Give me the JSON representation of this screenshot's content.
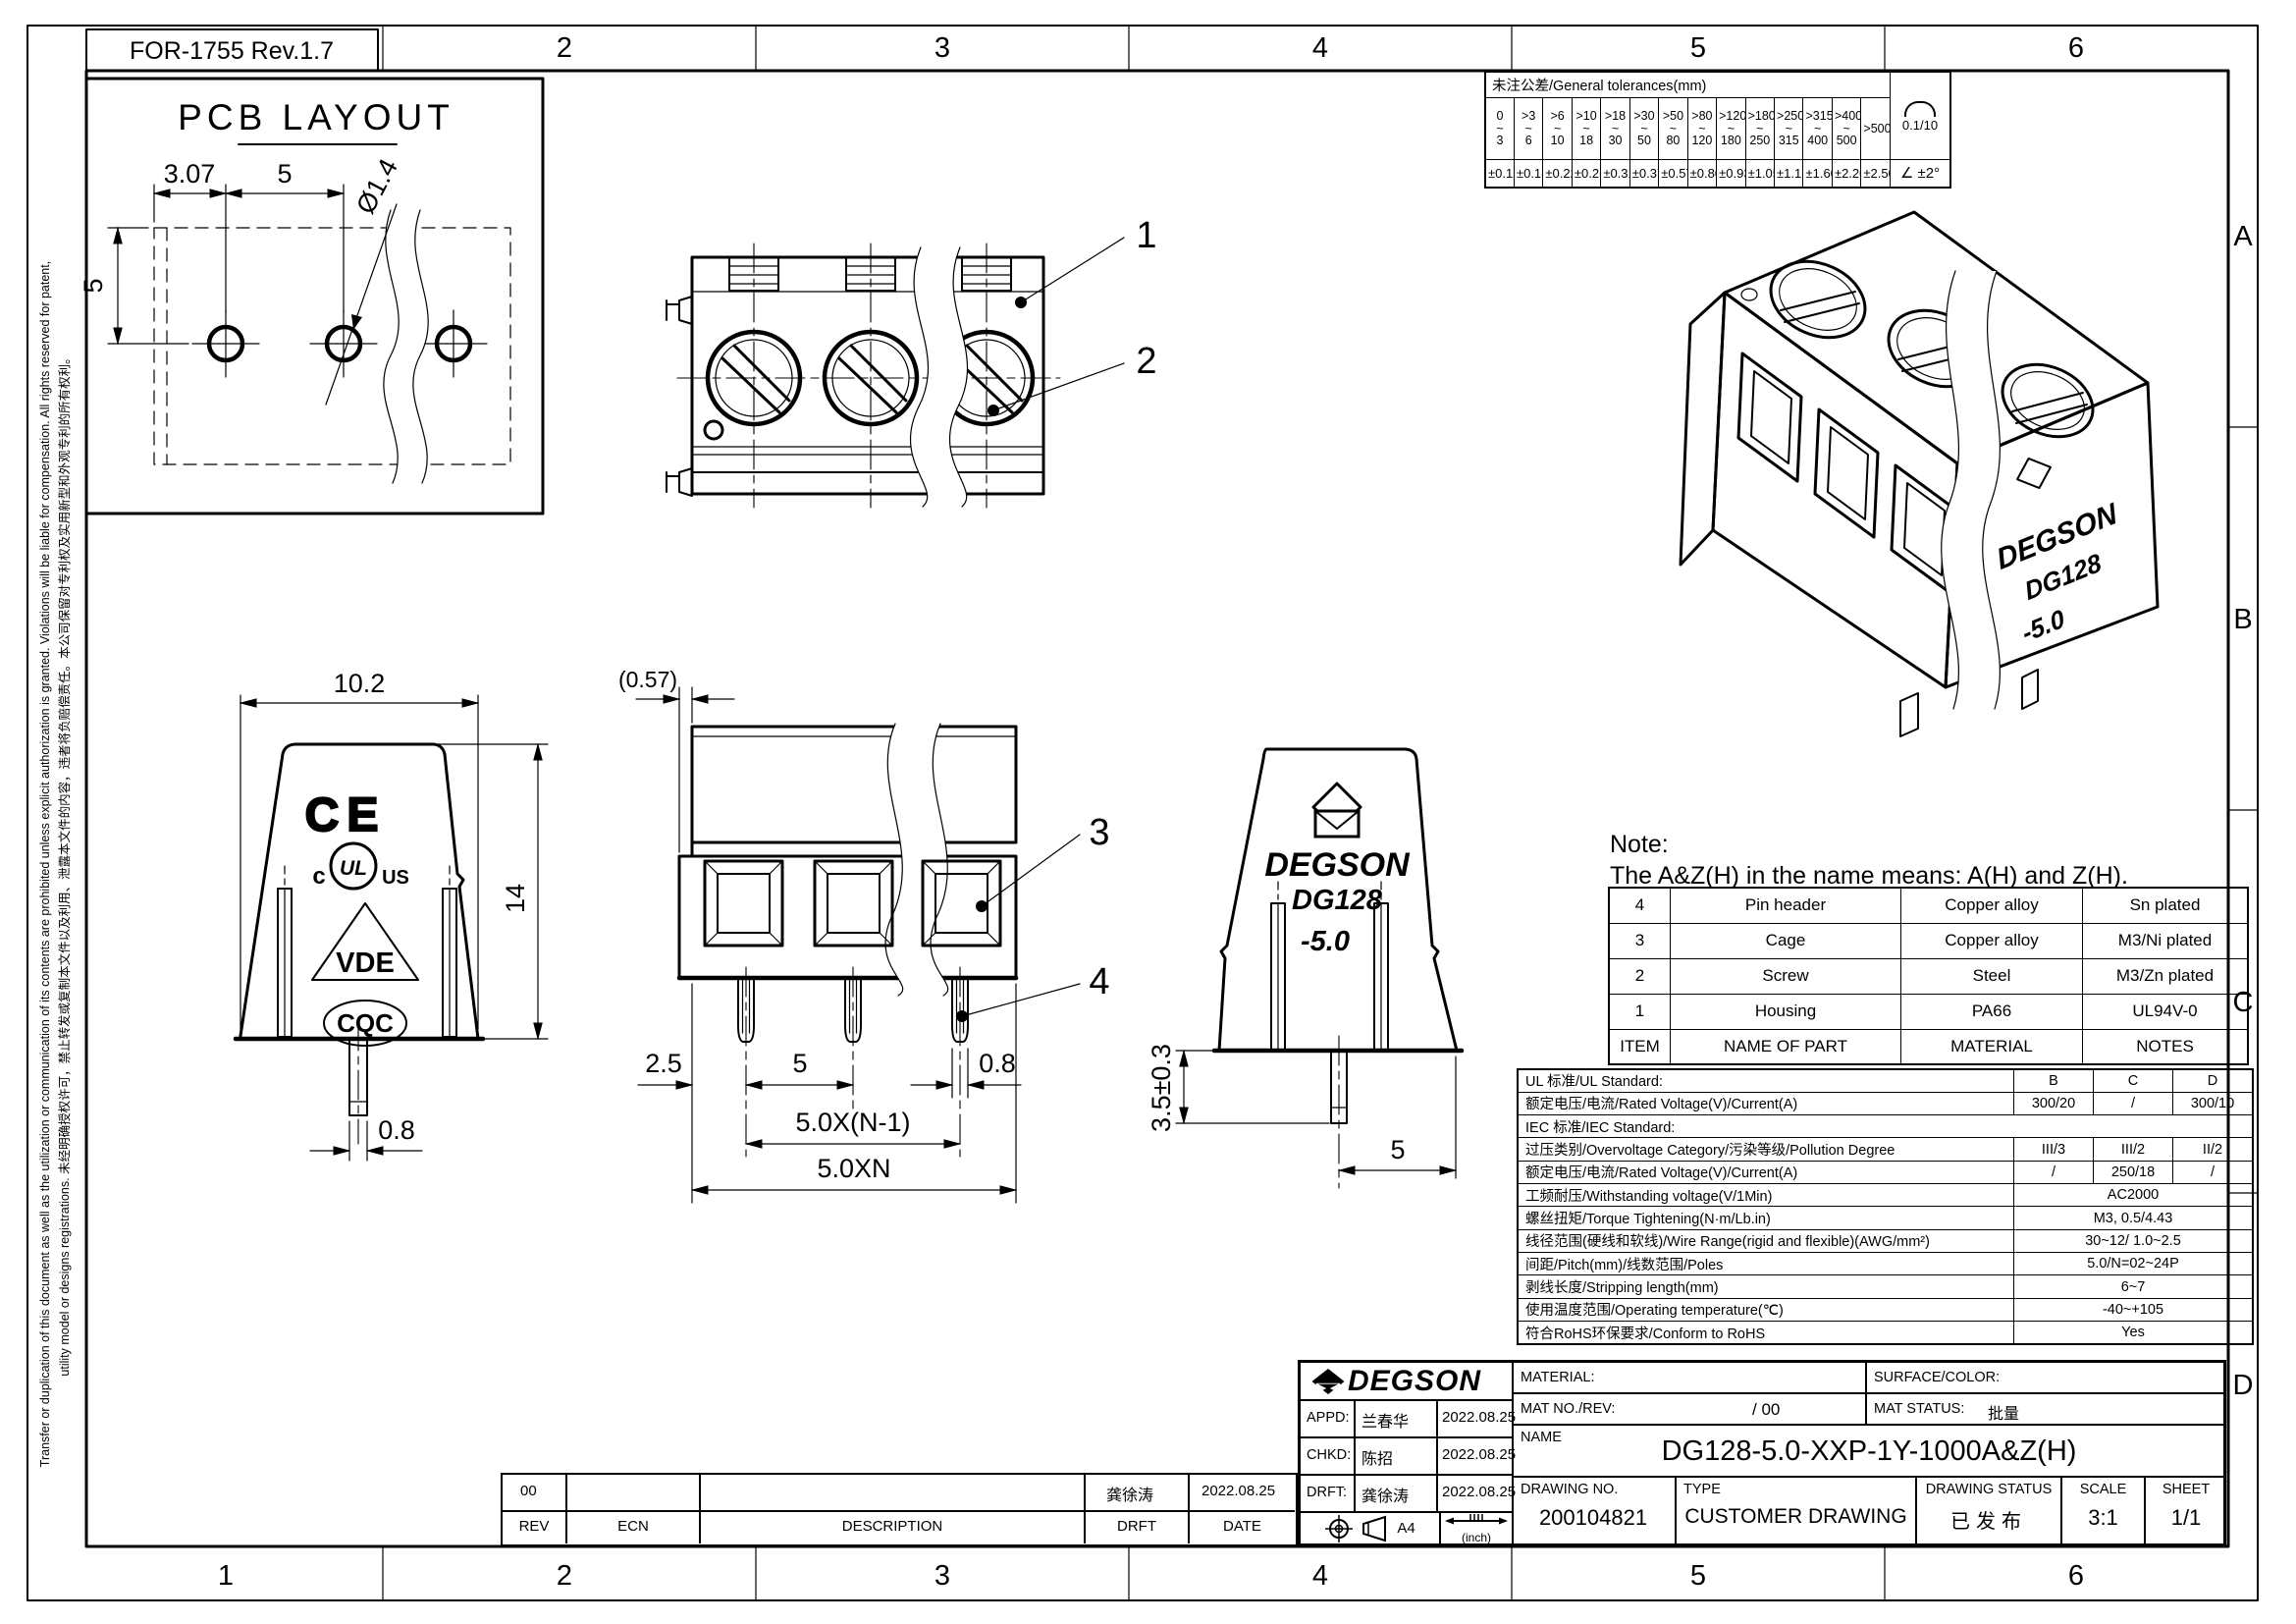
{
  "frame": {
    "form_label": "FOR-1755 Rev.1.7",
    "cols_top": [
      "2",
      "3",
      "4",
      "5",
      "6"
    ],
    "cols_bottom": [
      "1",
      "2",
      "3",
      "4",
      "5",
      "6"
    ],
    "rows_right": [
      "A",
      "B",
      "C",
      "D"
    ],
    "disclaimer_line1": "Transfer or duplication of this document as well as the utilization or communication of its contents are prohibited unless explicit authorization is granted. Violations will be liable for compensation. All rights reserved for patent,",
    "disclaimer_line2": "utility model or designs registrations. 未经明确授权许可，禁止转发或复制本文件以及利用、泄露本文件的内容，违者将负赔偿责任。本公司保留对专利权及实用新型和外观专利的所有权利。"
  },
  "pcb": {
    "title": "PCB LAYOUT"
  },
  "dims": {
    "pcb_307": "3.07",
    "pcb_5h": "5",
    "pcb_5v": "5",
    "pcb_dia": "Ø1.4",
    "end_102": "10.2",
    "end_14": "14",
    "end_08": "0.8",
    "front_057": "(0.57)",
    "front_25": "2.5",
    "front_5": "5",
    "front_08": "0.8",
    "front_pitch": "5.0X(N-1)",
    "front_total": "5.0XN",
    "back_35": "3.5±0.3",
    "back_5": "5"
  },
  "callouts": {
    "c1": "1",
    "c2": "2",
    "c3": "3",
    "c4": "4"
  },
  "marks": {
    "ce": "CE",
    "ul_c": "c",
    "ul": "UL",
    "ul_us": "US",
    "vde": "VDE",
    "cqc": "CQC"
  },
  "branding": {
    "brand": "DEGSON",
    "model": "DG128",
    "pitch": "-5.0"
  },
  "note": {
    "line1": "Note:",
    "line2": "The A&Z(H) in the name means: A(H) and Z(H)."
  },
  "tolerances": {
    "title": "未注公差/General tolerances(mm)",
    "ranges": [
      "0\n~\n3",
      ">3\n~\n6",
      ">6\n~\n10",
      ">10\n~\n18",
      ">18\n~\n30",
      ">30\n~\n50",
      ">50\n~\n80",
      ">80\n~\n120",
      ">120\n~\n180",
      ">180\n~\n250",
      ">250\n~\n315",
      ">315\n~\n400",
      ">400\n~\n500",
      ">500"
    ],
    "values": [
      "±0.12",
      "±0.18",
      "±0.22",
      "±0.26",
      "±0.31",
      "±0.37",
      "±0.57",
      "±0.80",
      "±0.93",
      "±1.05",
      "±1.15",
      "±1.60",
      "±2.20",
      "±2.50"
    ],
    "flatness": "0.1/10",
    "angle_symbol": "∠",
    "angle": "±2°"
  },
  "parts": {
    "headers": [
      "ITEM",
      "NAME OF PART",
      "MATERIAL",
      "NOTES"
    ],
    "rows": [
      [
        "4",
        "Pin header",
        "Copper alloy",
        "Sn plated"
      ],
      [
        "3",
        "Cage",
        "Copper alloy",
        "M3/Ni plated"
      ],
      [
        "2",
        "Screw",
        "Steel",
        "M3/Zn plated"
      ],
      [
        "1",
        "Housing",
        "PA66",
        "UL94V-0"
      ]
    ]
  },
  "specs": {
    "rows": [
      {
        "label": "UL 标准/UL Standard:",
        "b": "B",
        "c": "C",
        "d": "D"
      },
      {
        "label": "额定电压/电流/Rated Voltage(V)/Current(A)",
        "b": "300/20",
        "c": "/",
        "d": "300/10"
      },
      {
        "label": "IEC 标准/IEC Standard:"
      },
      {
        "label": "过压类别/Overvoltage Category/污染等级/Pollution Degree",
        "b": "III/3",
        "c": "III/2",
        "d": "II/2"
      },
      {
        "label": "额定电压/电流/Rated Voltage(V)/Current(A)",
        "b": "/",
        "c": "250/18",
        "d": "/"
      },
      {
        "label": "工频耐压/Withstanding voltage(V/1Min)",
        "v": "AC2000"
      },
      {
        "label": "螺丝扭矩/Torque Tightening(N·m/Lb.in)",
        "v": "M3, 0.5/4.43"
      },
      {
        "label": "线径范围(硬线和软线)/Wire Range(rigid and flexible)(AWG/mm²)",
        "v": "30~12/ 1.0~2.5"
      },
      {
        "label": "间距/Pitch(mm)/线数范围/Poles",
        "v": "5.0/N=02~24P"
      },
      {
        "label": "剥线长度/Stripping length(mm)",
        "v": "6~7"
      },
      {
        "label": "使用温度范围/Operating temperature(℃)",
        "v": "-40~+105"
      },
      {
        "label": "符合RoHS环保要求/Conform to RoHS",
        "v": "Yes"
      }
    ]
  },
  "titleblock": {
    "brand": "DEGSON",
    "material_label": "MATERIAL:",
    "surface_label": "SURFACE/COLOR:",
    "matno_label": "MAT NO./REV:",
    "matno_value": "/ 00",
    "matstatus_label": "MAT STATUS:",
    "matstatus_value": "批量",
    "appd_label": "APPD:",
    "appd_name": "兰春华",
    "appd_date": "2022.08.25",
    "chkd_label": "CHKD:",
    "chkd_name": "陈招",
    "chkd_date": "2022.08.25",
    "drft_label": "DRFT:",
    "drft_name": "龚徐涛",
    "drft_date": "2022.08.25",
    "name_label": "NAME",
    "name_value": "DG128-5.0-XXP-1Y-1000A&Z(H)",
    "drawing_no_label": "DRAWING NO.",
    "drawing_no_value": "200104821",
    "type_label": "TYPE",
    "type_value": "CUSTOMER DRAWING",
    "status_label": "DRAWING STATUS",
    "status_value": "已发布",
    "scale_label": "SCALE",
    "scale_value": "3:1",
    "sheet_label": "SHEET",
    "sheet_value": "1/1",
    "paper": "A4",
    "inch_label": "(inch)"
  },
  "revision": {
    "headers": [
      "REV",
      "ECN",
      "DESCRIPTION",
      "DRFT",
      "DATE"
    ],
    "rev": "00",
    "drft_name": "龚徐涛",
    "date": "2022.08.25"
  }
}
